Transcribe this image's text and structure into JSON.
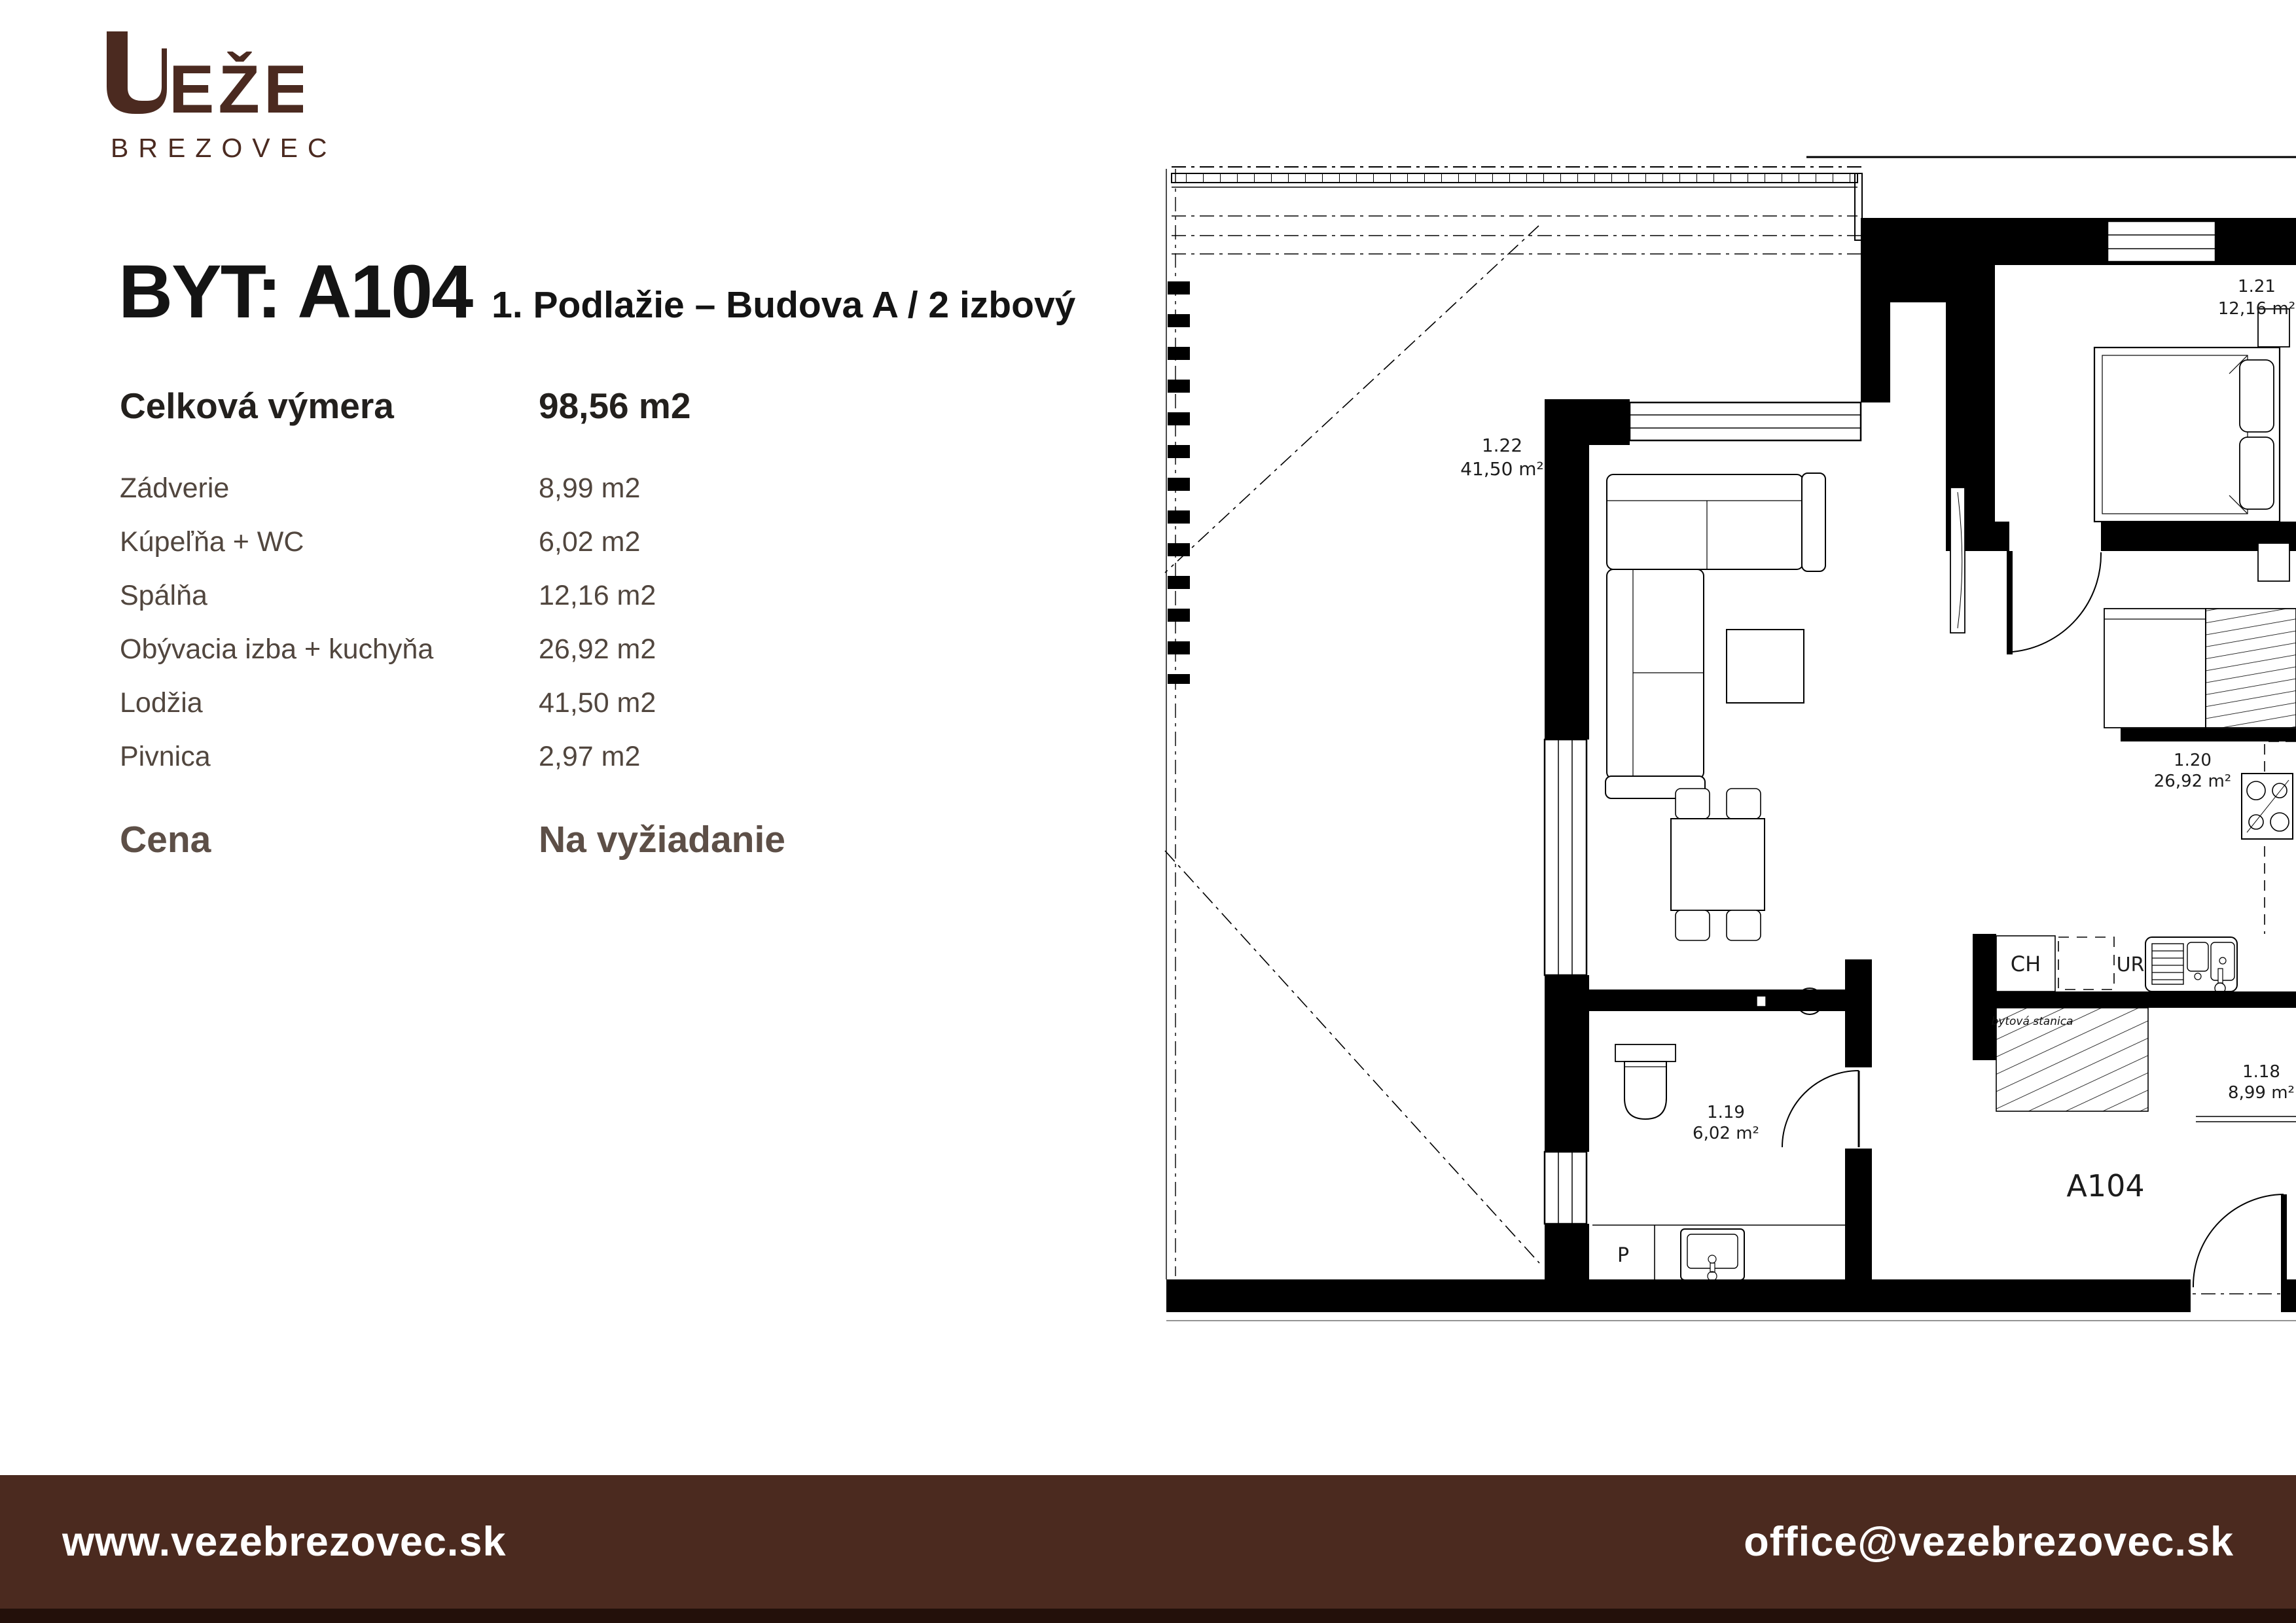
{
  "logo": {
    "name": "VEŽE",
    "subtitle": "BREZOVEC"
  },
  "header": {
    "title": "BYT: A104",
    "subtitle": "1. Podlažie – Budova A / 2 izbový"
  },
  "summary": {
    "label": "Celková výmera",
    "value": "98,56 m2"
  },
  "rooms": [
    {
      "label": "Zádverie",
      "value": "8,99 m2"
    },
    {
      "label": "Kúpeľňa + WC",
      "value": "6,02 m2"
    },
    {
      "label": "Spálňa",
      "value": "12,16 m2"
    },
    {
      "label": "Obývacia izba + kuchyňa",
      "value": "26,92 m2"
    },
    {
      "label": "Lodžia",
      "value": "41,50 m2"
    },
    {
      "label": "Pivnica",
      "value": "2,97 m2"
    }
  ],
  "price": {
    "label": "Cena",
    "value": "Na vyžiadanie"
  },
  "footer": {
    "website": "www.vezebrezovec.sk",
    "email": "office@vezebrezovec.sk"
  },
  "colors": {
    "brand": "#4b2a1f",
    "text_dark": "#141414",
    "text_muted": "#51463e",
    "price_text": "#5d4f47"
  },
  "floorplan": {
    "unit_label": "A104",
    "rooms": [
      {
        "id": "1.22",
        "area": "41,50 m²"
      },
      {
        "id": "1.21",
        "area": "12,16 m²"
      },
      {
        "id": "1.20",
        "area": "26,92 m²"
      },
      {
        "id": "1.19",
        "area": "6,02 m²"
      },
      {
        "id": "1.18",
        "area": "8,99 m²"
      }
    ],
    "annotations": {
      "ch": "CH",
      "ur": "UR",
      "p": "P",
      "tech_room": "bytová stanica"
    }
  }
}
